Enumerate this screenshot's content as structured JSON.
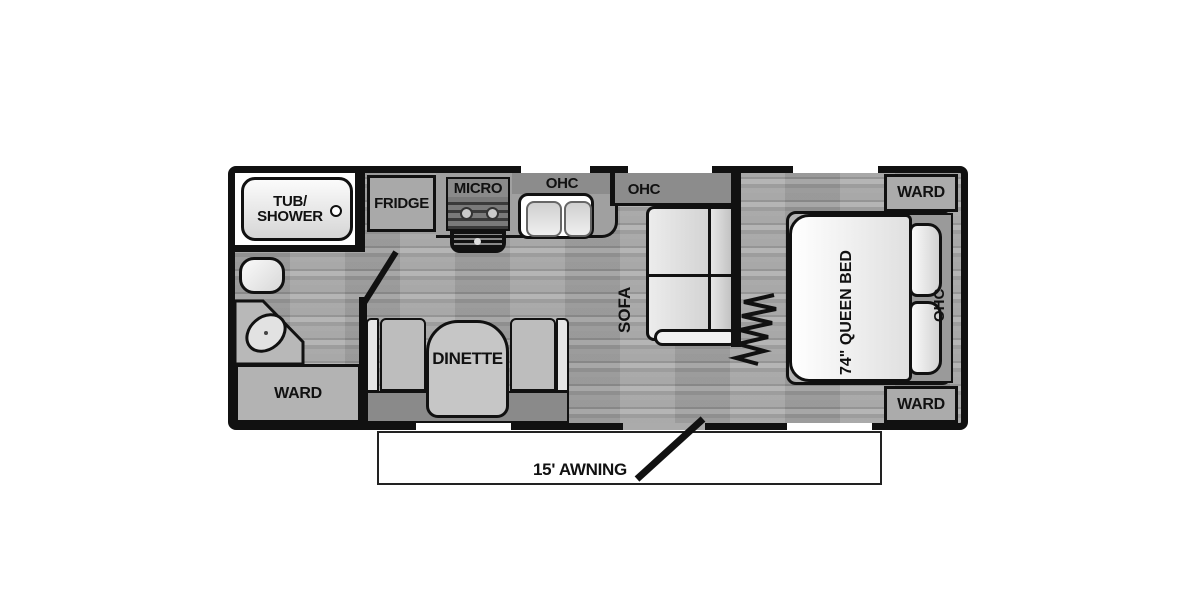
{
  "labels": {
    "tub_shower_line1": "TUB/",
    "tub_shower_line2": "SHOWER",
    "fridge": "FRIDGE",
    "micro": "MICRO",
    "ohc_kitchen": "OHC",
    "ohc_sofa": "OHC",
    "sofa": "SOFA",
    "dinette": "DINETTE",
    "ohc_dinette": "OHC",
    "ward_bath": "WARD",
    "ward_top_right": "WARD",
    "ward_bottom_right": "WARD",
    "queen_bed": "74\" QUEEN BED",
    "ohc_bedroom": "OHC",
    "awning": "15' AWNING"
  },
  "colors": {
    "wall": "#111111",
    "floor": "#9e9e9e",
    "cabinet_gray": "#8c8c8c",
    "furniture_light": "#c6c6c6",
    "fixture_white": "#ffffff"
  }
}
